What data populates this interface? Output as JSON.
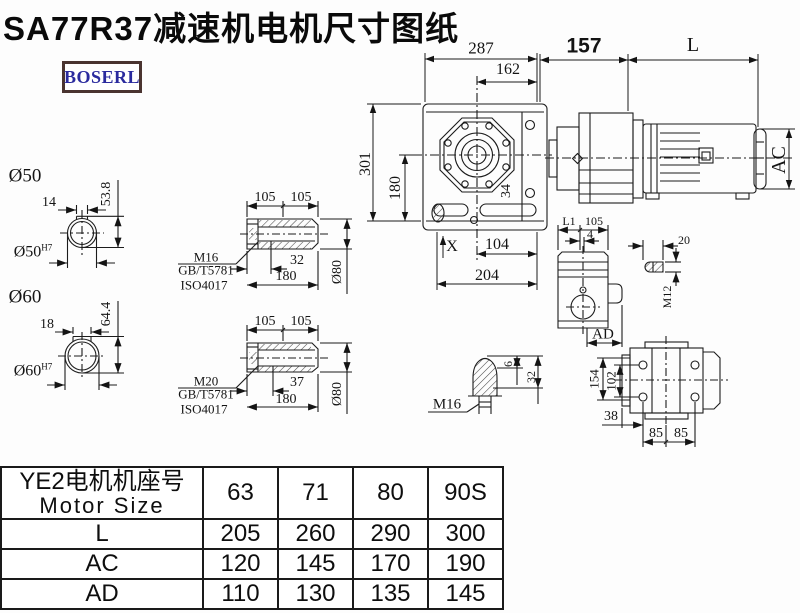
{
  "title": "SA77R37减速机电机尺寸图纸",
  "logo_text": "BOSERL",
  "main_view": {
    "dim_287": "287",
    "dim_162": "162",
    "dim_157": "157",
    "dim_L": "L",
    "dim_301": "301",
    "dim_180": "180",
    "dim_AC": "AC",
    "dim_X": "X",
    "dim_104": "104",
    "dim_204": "204",
    "dim_34": "34"
  },
  "shaft_cs_50": {
    "label": "Ø50",
    "key_width": "14",
    "height": "53.8",
    "bore": "Ø50",
    "bore_sup": "H7"
  },
  "shaft_cs_60": {
    "label": "Ø60",
    "key_width": "18",
    "height": "64.4",
    "bore": "Ø60",
    "bore_sup": "H7"
  },
  "hollow_shaft_m16": {
    "dim_105a": "105",
    "dim_105b": "105",
    "thread": "M16",
    "std_gb": "GB/T5781",
    "std_iso": "ISO4017",
    "bore_depth": "32",
    "length": "180",
    "dia": "Ø80"
  },
  "hollow_shaft_m20": {
    "dim_105a": "105",
    "dim_105b": "105",
    "thread": "M20",
    "std_gb": "GB/T5781",
    "std_iso": "ISO4017",
    "bore_depth": "37",
    "length": "180",
    "dia": "Ø80"
  },
  "side_view": {
    "dim_L1": "L1",
    "dim_105": "105",
    "dim_4": "4",
    "dim_AD": "AD"
  },
  "key_detail": {
    "dim_20": "20",
    "thread": "M12"
  },
  "plug_detail": {
    "thread": "M16",
    "dim_6": "6",
    "dim_32": "32"
  },
  "flange_view": {
    "dim_154": "154",
    "dim_102": "102",
    "dim_38": "38",
    "dim_85a": "85",
    "dim_85b": "85"
  },
  "table": {
    "header_cn": "YE2电机机座号",
    "header_en": "Motor Size",
    "columns": [
      "63",
      "71",
      "80",
      "90S"
    ],
    "rows": [
      {
        "label": "L",
        "values": [
          "205",
          "260",
          "290",
          "300"
        ]
      },
      {
        "label": "AC",
        "values": [
          "120",
          "145",
          "170",
          "190"
        ]
      },
      {
        "label": "AD",
        "values": [
          "110",
          "130",
          "135",
          "145"
        ]
      }
    ]
  }
}
